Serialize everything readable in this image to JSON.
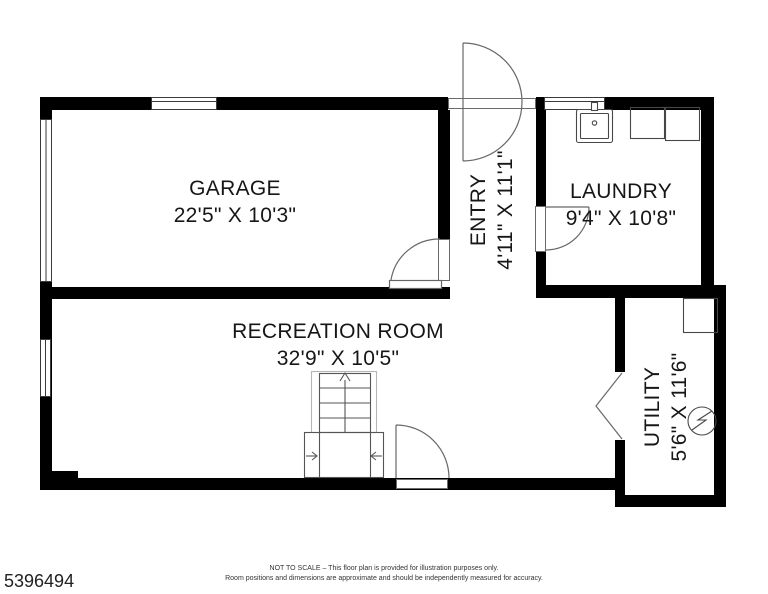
{
  "rooms": {
    "garage": {
      "name": "GARAGE",
      "dims": "22'5\" X 10'3\""
    },
    "entry": {
      "name": "ENTRY",
      "dims": "4'11\" X 11'1\""
    },
    "laundry": {
      "name": "LAUNDRY",
      "dims": "9'4\" X 10'8\""
    },
    "recreation": {
      "name": "RECREATION ROOM",
      "dims": "32'9\" X 10'5\""
    },
    "utility": {
      "name": "UTILITY",
      "dims": "5'6\" X 11'6\""
    }
  },
  "footer": {
    "listing_id": "5396494",
    "disclaimer_line1": "NOT TO SCALE – This floor plan is provided for illustration purposes only.",
    "disclaimer_line2": "Room positions and dimensions are approximate and should be independently measured for accuracy."
  },
  "colors": {
    "wall": "#000000",
    "thin_line": "#5a5a5a",
    "fixture_line": "#444444",
    "stair_ghost": "#b5b5b5",
    "background": "#ffffff"
  }
}
